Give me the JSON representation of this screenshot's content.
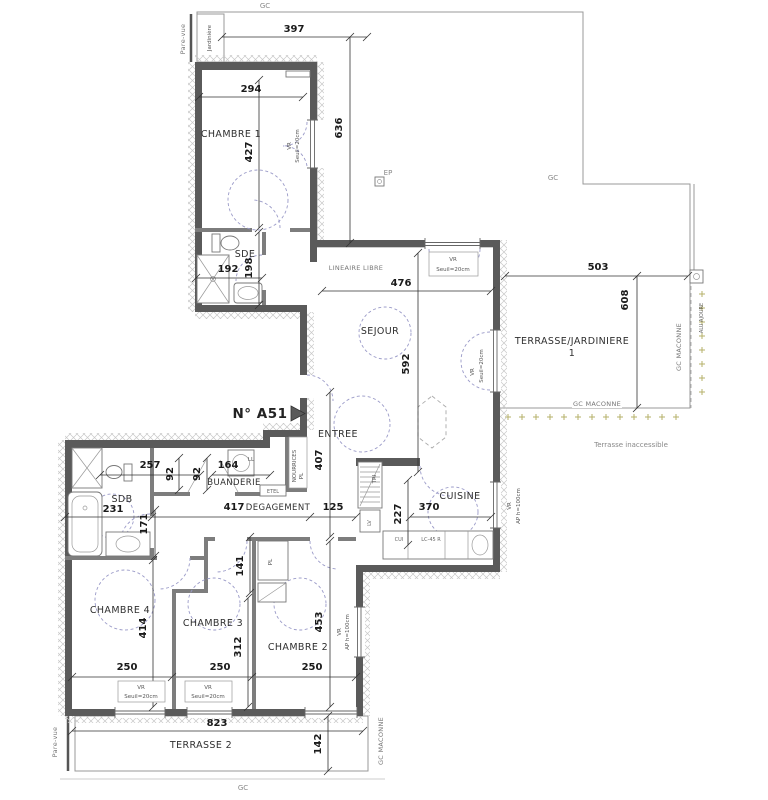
{
  "plan": {
    "apartment_number": "N° A51",
    "rooms": {
      "chambre1": "CHAMBRE 1",
      "sde": "SDE",
      "sejour": "SEJOUR",
      "terrasse_jardiniere": "TERRASSE/JARDINIERE",
      "terrasse_jardiniere_num": "1",
      "entree": "ENTREE",
      "buanderie": "BUANDERIE",
      "degagement": "DEGAGEMENT",
      "cuisine": "CUISINE",
      "sdb": "SDB",
      "chambre2": "CHAMBRE 2",
      "chambre3": "CHAMBRE 3",
      "chambre4": "CHAMBRE 4",
      "terrasse2": "TERRASSE 2"
    },
    "dims": {
      "top_width": "397",
      "ch1_width": "294",
      "ch1_height": "427",
      "terrace_height": "636",
      "sde_width": "192",
      "sde_height": "198",
      "sejour_width": "476",
      "terrasse1_width": "503",
      "terrasse1_height": "608",
      "sejour_height": "592",
      "entree_height": "407",
      "sdb_top": "257",
      "w92a": "92",
      "w92b": "92",
      "buanderie_width": "164",
      "sdb_width": "231",
      "sdb_side": "171",
      "degagement_length": "417",
      "hall_width": "125",
      "tri_height": "227",
      "cuisine_width": "370",
      "nook_height": "141",
      "ch4_height": "414",
      "ch3_height": "312",
      "ch2_height": "453",
      "ch4_width": "250",
      "ch3_width": "250",
      "ch2_width": "250",
      "terrasse2_width": "823",
      "terrasse2_depth": "142"
    },
    "annotations": {
      "gc": "GC",
      "gc_maconne": "GC MACONNE",
      "pare_vue": "Pare-vue",
      "jardiniere": "Jardinière",
      "ep": "EP",
      "lineaire_libre": "LINEAIRE LIBRE",
      "terrasse_inaccessible": "Terrasse inaccessible",
      "alu_ajoure": "ALU AJOURE",
      "vr": "VR",
      "seuil": "Seuil=20cm",
      "ap100": "AP h=100cm",
      "ll": "LL",
      "etel": "ETEL",
      "nourrices": "NOURRICES",
      "pl": "PL",
      "tri": "TRI",
      "lv": "LV",
      "cui": "CUI",
      "lc45": "LC-45 R"
    },
    "colors": {
      "wall": "#5a5a5a",
      "partition": "#7d7d7d",
      "grid": "#cccccc",
      "boundary": "#999999",
      "door_dash": "#9a9ac8",
      "dim_text": "#1a1a1a",
      "dots": "#b5b06a"
    }
  }
}
